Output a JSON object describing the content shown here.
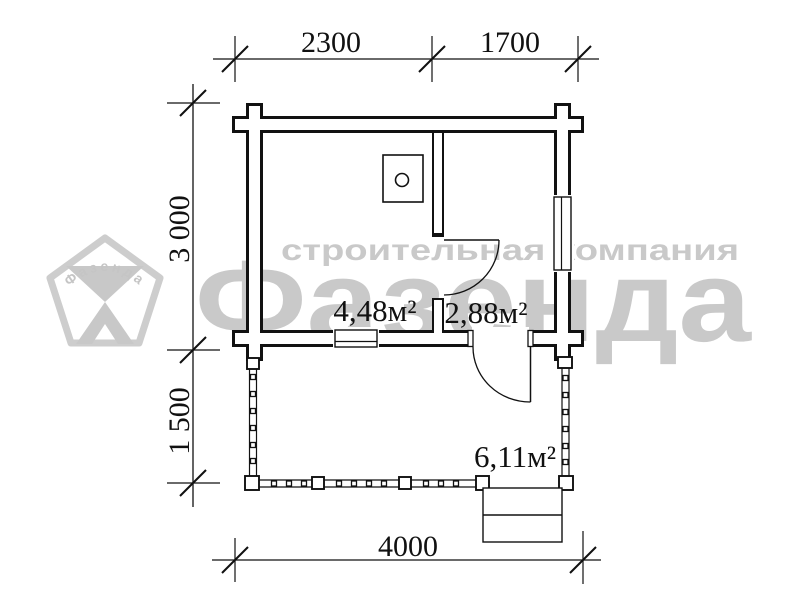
{
  "colors": {
    "line": "#111111",
    "watermark": "#c9c9c9",
    "watermark_light": "#cdcdcd"
  },
  "dimensions": {
    "width_left": "2300",
    "width_right": "1700",
    "depth_house": "3 000",
    "depth_terrace": "1 500",
    "width_total": "4000"
  },
  "rooms": {
    "main_area": "4,48м²",
    "entry_area": "2,88м²",
    "terrace_area": "6,11м²"
  },
  "watermark": {
    "slogan": "строительная компания",
    "brand": "Фазенда",
    "logo_text": "Фазенда"
  }
}
